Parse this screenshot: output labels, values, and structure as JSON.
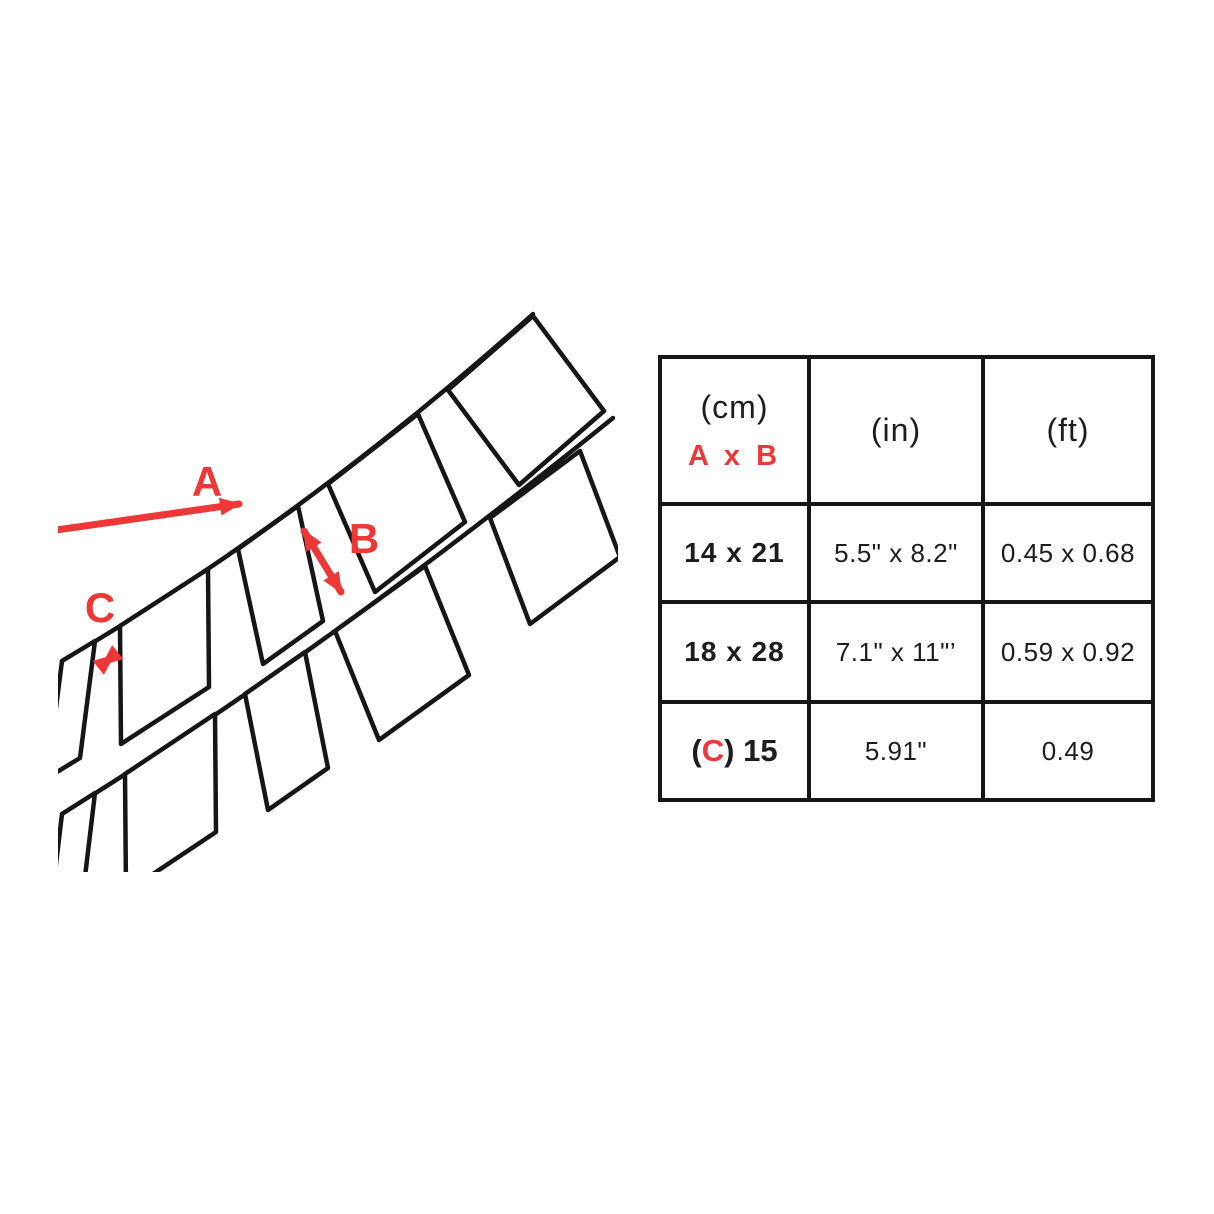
{
  "colors": {
    "accent_red": "#EE3737",
    "line_black": "#161616",
    "background": "#FFFFFF"
  },
  "diagram": {
    "labels": {
      "a": "A",
      "b": "B",
      "c": "C"
    }
  },
  "table": {
    "headers": [
      {
        "line1": "(cm)",
        "line2": "A x B"
      },
      {
        "line1": "(in)"
      },
      {
        "line1": "(ft)"
      }
    ],
    "rows": [
      {
        "cm": "14 x 21",
        "in": "5.5\" x 8.2\"",
        "ft": "0.45 x 0.68"
      },
      {
        "cm": "18 x 28",
        "in": "7.1\" x 11\"’",
        "ft": "0.59 x 0.92"
      },
      {
        "cm_prefix": "(",
        "cm_letter": "C",
        "cm_suffix": ") 15",
        "in": "5.91\"",
        "ft": "0.49"
      }
    ]
  }
}
